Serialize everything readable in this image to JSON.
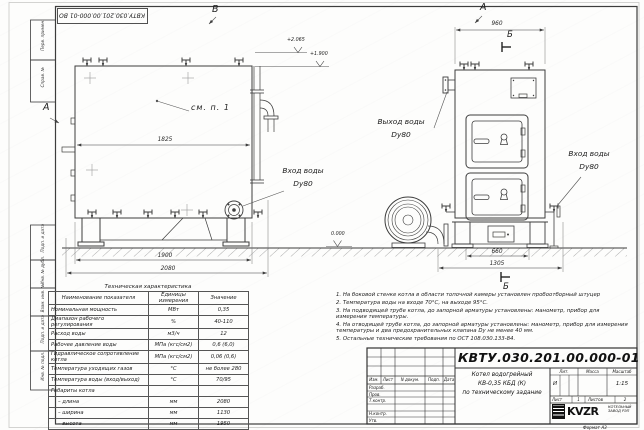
{
  "stamp_top": {
    "doc_number_inverted": "КВТУ.030.201.00.000-01 ВО"
  },
  "margin_labels": [
    "Перв. примен.",
    "Справ. №",
    "Подп. и дата",
    "Инв. № дубл.",
    "Взам. инв. №",
    "Подп. и дата",
    "Инв. № подл."
  ],
  "view_markers": {
    "top_b": "В",
    "left_a": "А",
    "right_a": "А",
    "section_b_top": "Б",
    "section_b_bottom": "Б"
  },
  "annotations": {
    "see_item": "см. п. 1",
    "elev_top": "+2.065",
    "elev_mid": "+1.900",
    "elev_zero": "0.000"
  },
  "pipe_labels": {
    "inlet_left_1": "Вход воды",
    "inlet_left_2": "Dy80",
    "outlet_1": "Выход воды",
    "outlet_2": "Dy80",
    "inlet_right_1": "Вход воды",
    "inlet_right_2": "Dy80"
  },
  "dimensions": {
    "left_width": "1825",
    "left_base": "1900",
    "left_total": "2080",
    "right_width": "960",
    "right_base": "660",
    "right_total": "1305"
  },
  "tech_table": {
    "title": "Техническая характеристика",
    "headers": [
      "Наименование показателя",
      "Единицы измерения",
      "Значение"
    ],
    "rows": [
      {
        "name": "Номинальная мощность",
        "unit": "МВт",
        "value": "0,35"
      },
      {
        "name": "Диапазон рабочего регулирования",
        "unit": "%",
        "value": "40-110"
      },
      {
        "name": "Расход воды",
        "unit": "м3/ч",
        "value": "12"
      },
      {
        "name": "Рабочее давление воды",
        "unit": "МПа (кгс/см2)",
        "value": "0,6 (6,0)"
      },
      {
        "name": "Гидравлическое сопротивление котла",
        "unit": "МПа (кгс/см2)",
        "value": "0,06 (0,6)"
      },
      {
        "name": "Температура уходящих газов",
        "unit": "°С",
        "value": "не более 280"
      },
      {
        "name": "Температура воды (вход/выход)",
        "unit": "°С",
        "value": "70/95"
      },
      {
        "name": "Габариты котла",
        "unit": "",
        "value": ""
      },
      {
        "name": "– длина",
        "unit": "мм",
        "value": "2080"
      },
      {
        "name": "– ширина",
        "unit": "мм",
        "value": "1130"
      },
      {
        "name": "– высота",
        "unit": "мм",
        "value": "1950"
      }
    ]
  },
  "notes": [
    "1. На боковой стенке котла в области топочной камеры установлен пробоотборный штуцер",
    "2. Температура воды на входе 70°С, на выходе 95°С.",
    "3. На подводящей трубе котла, до запорной арматуры установлены: манометр, прибор для измерения температуры.",
    "4. На отводящей трубе котла, до запорной арматуры установлены: манометр, прибор для измерения температуры и два предохранительных клапана Dy не менее 40 мм.",
    "5. Остальные технические требования по ОСТ 108.030.133-84."
  ],
  "title_block": {
    "doc_number": "КВТУ.030.201.00.000-01 ВО",
    "product_line1": "Котел водогрейный",
    "product_line2": "КВ-0,35 КБД (К)",
    "product_line3": "по техническому задание",
    "header_izm": "Изм.",
    "header_list": "Лист",
    "header_ndoc": "N докум.",
    "header_podp": "Подп.",
    "header_data": "Дата",
    "row_labels": [
      "Разраб.",
      "Пров.",
      "Т.контр.",
      "",
      "Н.контр.",
      "Утв."
    ],
    "lit_label": "Лит.",
    "mass_label": "Масса",
    "scale_label": "Масштаб",
    "lit_value": "И",
    "scale_value": "1:15",
    "sheet_label": "Лист",
    "sheet_value": "1",
    "sheets_label": "Листов",
    "sheets_value": "2",
    "logo_text": "KVZR",
    "company_line1": "КОТЕЛЬНЫЙ",
    "company_line2": "ЗАВОД РЭП"
  },
  "format_label": "Формат  А3"
}
